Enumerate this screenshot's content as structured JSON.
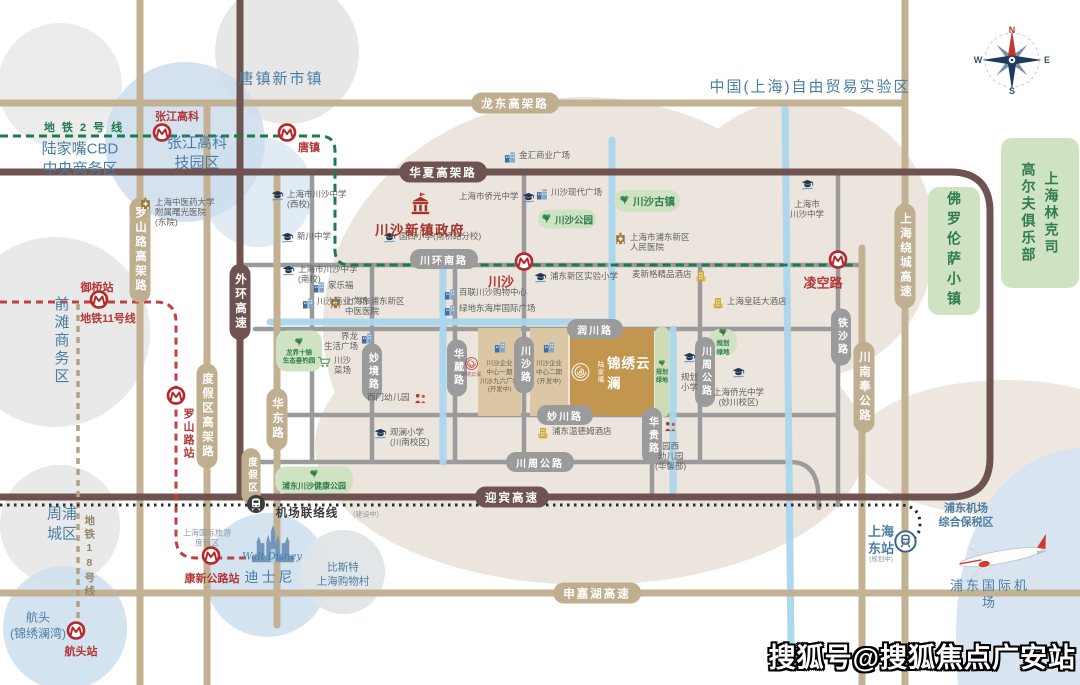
{
  "watermark": {
    "text": "搜狐号@搜狐焦点广安站"
  },
  "compass": {
    "n": "N",
    "e": "E",
    "s": "S",
    "w": "W"
  },
  "project": {
    "brand": "陆家嘴",
    "name": "锦绣云澜"
  },
  "emblem": {
    "label": "锦绣云澜"
  },
  "disney": {
    "script": "Walt Disney"
  },
  "region_labels": [
    {
      "t": "唐镇新市镇",
      "x": 281,
      "y": 79,
      "s": 15,
      "c": "blue",
      "ls": 2
    },
    {
      "t": "中国(上海)自由贸易实验区",
      "x": 810,
      "y": 87,
      "s": 15,
      "c": "blue",
      "ls": 2
    },
    {
      "t": "地 铁 2 号 线",
      "x": 84,
      "y": 128,
      "s": 11,
      "c": "green",
      "b": 1
    },
    {
      "t": "陆家嘴CBD\n中央商务区",
      "x": 80,
      "y": 159,
      "s": 15,
      "c": "blue"
    },
    {
      "t": "张江高科\n技园区",
      "x": 197,
      "y": 153,
      "s": 15,
      "c": "blue"
    },
    {
      "t": "前滩商务区",
      "x": 61,
      "y": 341,
      "s": 15,
      "c": "blue",
      "v": 1
    },
    {
      "t": "地铁11号线",
      "x": 108,
      "y": 319,
      "s": 11,
      "c": "red",
      "b": 1
    },
    {
      "t": "周浦\n城区",
      "x": 62,
      "y": 524,
      "s": 15,
      "c": "blue"
    },
    {
      "t": "地铁18号线",
      "x": 89,
      "y": 557,
      "s": 10.5,
      "c": "tan",
      "v": 1,
      "b": 1
    },
    {
      "t": "上海国际旅游\n度假区",
      "x": 207,
      "y": 539,
      "s": 8,
      "c": "dim"
    },
    {
      "t": "航头\n(锦绣澜湾)",
      "x": 38,
      "y": 626,
      "s": 12,
      "c": "blue"
    },
    {
      "t": "迪士尼",
      "x": 270,
      "y": 577,
      "s": 14,
      "c": "blue",
      "ls": 3
    },
    {
      "t": "比斯特\n上海购物村",
      "x": 343,
      "y": 575,
      "s": 10.5,
      "c": "blue"
    },
    {
      "t": "机场联络线",
      "x": 307,
      "y": 514,
      "s": 11.5,
      "c": "black",
      "b": 1,
      "ls": 1
    },
    {
      "t": "(建设中)",
      "x": 366,
      "y": 515,
      "s": 7,
      "c": "dim"
    },
    {
      "t": "浦东机场\n综合保税区",
      "x": 966,
      "y": 516,
      "s": 11,
      "c": "blue",
      "b": 1
    },
    {
      "t": "上海\n东站",
      "x": 881,
      "y": 541,
      "s": 13,
      "c": "blue",
      "b": 1
    },
    {
      "t": "(规划中)",
      "x": 881,
      "y": 560,
      "s": 6.5,
      "c": "dim"
    },
    {
      "t": "浦东国际机场",
      "x": 990,
      "y": 595,
      "s": 13,
      "c": "blue",
      "ls": 3
    }
  ],
  "road_labels": [
    {
      "t": "龙东高架路",
      "x": 515,
      "y": 103,
      "k": "tan"
    },
    {
      "t": "申嘉湖高速",
      "x": 597,
      "y": 593,
      "k": "tan"
    },
    {
      "t": "罗山路高架路",
      "x": 140,
      "y": 250,
      "k": "tan",
      "v": 1
    },
    {
      "t": "度假区高架路",
      "x": 207,
      "y": 416,
      "k": "tan",
      "v": 1
    },
    {
      "t": "华东路",
      "x": 277,
      "y": 419,
      "k": "tan",
      "v": 1
    },
    {
      "t": "上海绕城高速",
      "x": 905,
      "y": 256,
      "k": "tan",
      "v": 1
    },
    {
      "t": "川南奉公路",
      "x": 864,
      "y": 387,
      "k": "tan",
      "v": 1
    },
    {
      "t": "度假区",
      "x": 251,
      "y": 476,
      "k": "tan",
      "v": 1,
      "s": 9.5
    },
    {
      "t": "华夏高架路",
      "x": 443,
      "y": 172,
      "k": "dark"
    },
    {
      "t": "迎宾高速",
      "x": 512,
      "y": 497,
      "k": "dark"
    },
    {
      "t": "外环高速",
      "x": 240,
      "y": 302,
      "k": "dark",
      "v": 1
    },
    {
      "t": "川环南路",
      "x": 444,
      "y": 259,
      "k": "gray"
    },
    {
      "t": "润川路",
      "x": 595,
      "y": 329,
      "k": "gray"
    },
    {
      "t": "妙川路",
      "x": 565,
      "y": 415,
      "k": "gray"
    },
    {
      "t": "川周公路",
      "x": 540,
      "y": 462,
      "k": "gray"
    },
    {
      "t": "妙境路",
      "x": 372,
      "y": 372,
      "k": "gray",
      "v": 1
    },
    {
      "t": "华葳路",
      "x": 457,
      "y": 368,
      "k": "gray",
      "v": 1
    },
    {
      "t": "川沙路",
      "x": 524,
      "y": 365,
      "k": "gray",
      "v": 1
    },
    {
      "t": "川周公路",
      "x": 705,
      "y": 372,
      "k": "gray",
      "v": 1
    },
    {
      "t": "铁沙路",
      "x": 841,
      "y": 337,
      "k": "gray",
      "v": 1
    },
    {
      "t": "华贵路",
      "x": 652,
      "y": 436,
      "k": "gray",
      "v": 1
    }
  ],
  "stations": [
    {
      "n": "张江高科",
      "x": 162,
      "y": 135,
      "lx": 177,
      "ly": 116,
      "s": 11
    },
    {
      "n": "唐镇",
      "x": 287,
      "y": 135,
      "lx": 309,
      "ly": 147,
      "s": 11
    },
    {
      "n": "御桥站",
      "x": 99,
      "y": 302,
      "lx": 97,
      "ly": 287,
      "s": 11
    },
    {
      "n": "川沙",
      "x": 524,
      "y": 264,
      "lx": 501,
      "ly": 281,
      "s": 13
    },
    {
      "n": "凌空路",
      "x": 838,
      "y": 262,
      "lx": 823,
      "ly": 282,
      "s": 13
    },
    {
      "n": "罗山路站",
      "x": 176,
      "y": 398,
      "lx": 188,
      "ly": 434,
      "s": 11,
      "v": 1
    },
    {
      "n": "康新公路站",
      "x": 211,
      "y": 558,
      "lx": 212,
      "ly": 578,
      "s": 11
    },
    {
      "n": "航头站",
      "x": 76,
      "y": 633,
      "lx": 81,
      "ly": 651,
      "s": 11
    }
  ],
  "pois": [
    {
      "t": "上海市川沙中学\n(西校)",
      "x": 271,
      "y": 189,
      "type": "school"
    },
    {
      "t": "新川中学",
      "x": 281,
      "y": 231,
      "type": "school"
    },
    {
      "t": "国西小学(南桥路分校)",
      "x": 383,
      "y": 231,
      "type": "school"
    },
    {
      "t": "上海市侨光中学",
      "x": 459,
      "y": 191,
      "type": "school",
      "side": "r"
    },
    {
      "t": "上海市川沙中学\n(南校)",
      "x": 282,
      "y": 264,
      "type": "school"
    },
    {
      "t": "上海市\n川沙中学",
      "x": 790,
      "y": 178,
      "type": "school",
      "side": "t"
    },
    {
      "t": "浦东新区实验小学",
      "x": 534,
      "y": 271,
      "type": "school"
    },
    {
      "t": "观澜小学\n(川南校区)",
      "x": 374,
      "y": 427,
      "type": "school"
    },
    {
      "t": "规划\n小学",
      "x": 681,
      "y": 351,
      "type": "school",
      "side": "t"
    },
    {
      "t": "上海侨光中学\n(妙川校区)",
      "x": 713,
      "y": 366,
      "type": "school",
      "side": "t"
    },
    {
      "t": "上海中医药大学\n附属曙光医院\n(东院)",
      "x": 139,
      "y": 197,
      "type": "hospital"
    },
    {
      "t": "上海市浦东新区\n中医医院",
      "x": 329,
      "y": 296,
      "type": "hospital"
    },
    {
      "t": "上海市浦东新区\n人民医院",
      "x": 614,
      "y": 232,
      "type": "hospital"
    },
    {
      "t": "金汇商业广场",
      "x": 504,
      "y": 150,
      "type": "mall"
    },
    {
      "t": "川沙现代广场",
      "x": 536,
      "y": 187,
      "type": "mall"
    },
    {
      "t": "家乐福",
      "x": 313,
      "y": 280,
      "type": "mall"
    },
    {
      "t": "川沙商业广场",
      "x": 302,
      "y": 296,
      "type": "mall"
    },
    {
      "t": "百联川沙购物中心",
      "x": 444,
      "y": 287,
      "type": "mall"
    },
    {
      "t": "绿地东海岸国际广场",
      "x": 444,
      "y": 303,
      "type": "mall"
    },
    {
      "t": "界龙\n生活广场",
      "x": 324,
      "y": 331,
      "type": "mall",
      "side": "r"
    },
    {
      "t": "麦新格精品酒店",
      "x": 632,
      "y": 269,
      "type": "hotel",
      "side": "r"
    },
    {
      "t": "上海皇廷大酒店",
      "x": 712,
      "y": 296,
      "type": "hotel"
    },
    {
      "t": "浦东温德姆酒店",
      "x": 537,
      "y": 426,
      "type": "hotel"
    },
    {
      "t": "西门幼儿园",
      "x": 367,
      "y": 392,
      "type": "kind",
      "side": "r"
    },
    {
      "t": "园西\n幼儿园\n(华馨部)",
      "x": 655,
      "y": 420,
      "type": "kind",
      "side": "t"
    },
    {
      "t": "川沙\n菜场",
      "x": 317,
      "y": 355,
      "type": "market"
    },
    {
      "t": "川沙新镇政府",
      "x": 375,
      "y": 192,
      "type": "gov",
      "side": "t",
      "cls": "gov"
    },
    {
      "t": "",
      "x": 246,
      "y": 494,
      "type": "train"
    },
    {
      "t": "",
      "x": 894,
      "y": 530,
      "type": "rail"
    }
  ],
  "parks": [
    {
      "t": "川沙公园",
      "x": 567,
      "y": 219,
      "w": 58,
      "h": 19,
      "m": "row",
      "s": 9.5
    },
    {
      "t": "川沙古镇",
      "x": 647,
      "y": 201,
      "w": 66,
      "h": 22,
      "m": "row",
      "s": 10.5
    },
    {
      "t": "规划\n绿地",
      "x": 723,
      "y": 342,
      "w": 28,
      "h": 26,
      "m": "stack",
      "s": 6.5
    },
    {
      "t": "规划\n绿地",
      "x": 662,
      "y": 372,
      "w": 14,
      "h": 90,
      "m": "strip",
      "s": 6
    },
    {
      "t": "浦东川沙健康公园",
      "x": 314,
      "y": 480,
      "w": 78,
      "h": 27,
      "m": "stack",
      "s": 8
    },
    {
      "t": "龙界十锦\n生态垂钓园",
      "x": 299,
      "y": 351,
      "w": 46,
      "h": 41,
      "m": "stack",
      "s": 6.5
    },
    {
      "t": "佛罗伦萨小镇",
      "x": 954,
      "y": 251,
      "w": 52,
      "h": 128,
      "m": "v",
      "s": 14
    },
    {
      "t": "上海林克司|高尔夫俱乐部",
      "x": 1040,
      "y": 213,
      "w": 78,
      "h": 150,
      "m": "cols",
      "s": 14
    }
  ],
  "dev_blocks": [
    {
      "x": 478,
      "y": 328,
      "w": 43,
      "h": 88,
      "lines": [
        "川沙企业",
        "中心一期",
        "川沙九六广场",
        "(开发中)"
      ]
    },
    {
      "x": 530,
      "y": 328,
      "w": 38,
      "h": 88,
      "lines": [
        "川沙企业",
        "中心二期",
        "(开发中)"
      ]
    }
  ]
}
